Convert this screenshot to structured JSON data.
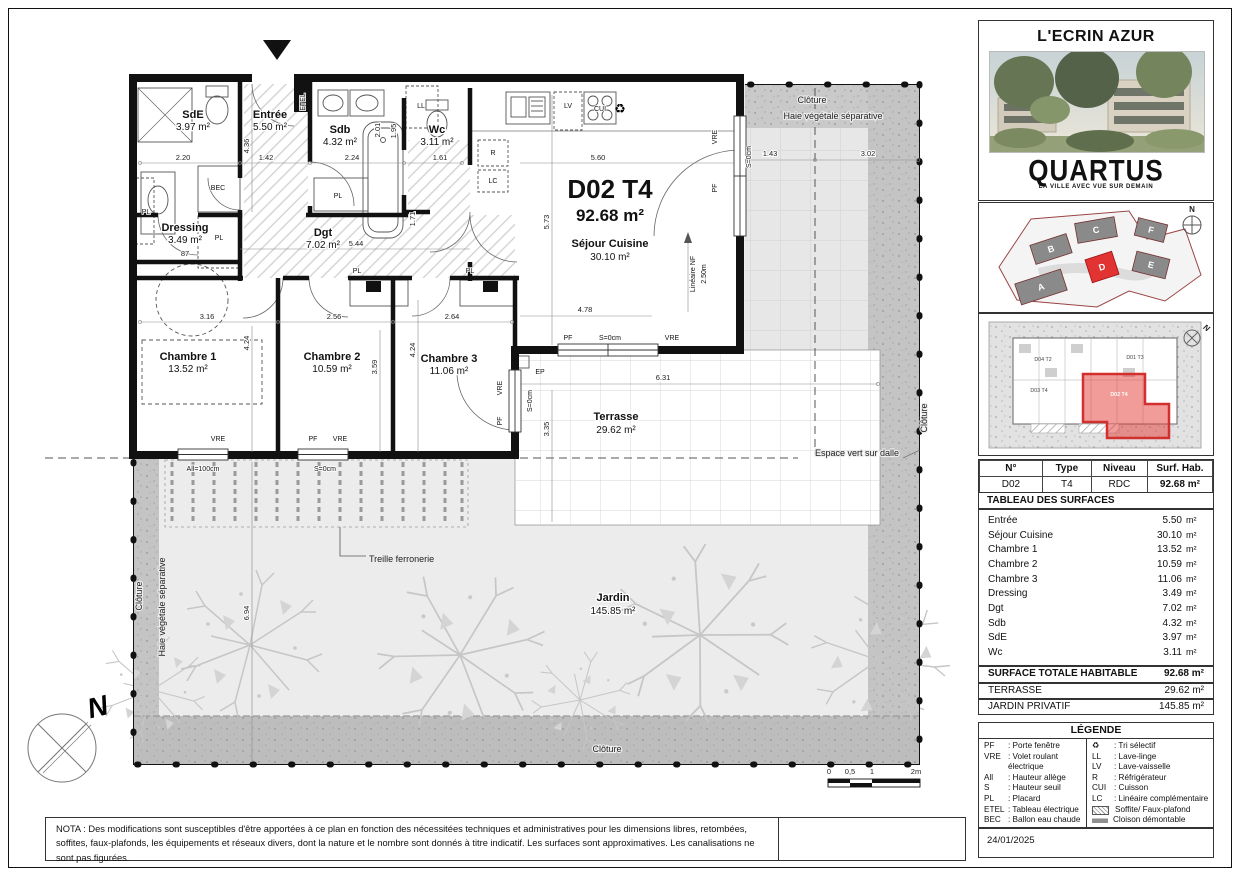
{
  "project": {
    "title": "L'ECRIN AZUR",
    "brand": "QUARTUS",
    "brand_tagline": "LA VILLE AVEC VUE SUR DEMAIN",
    "date": "24/01/2025",
    "north_letter": "N"
  },
  "info_table": {
    "headers": [
      "N°",
      "Type",
      "Niveau",
      "Surf. Hab."
    ],
    "row": [
      "D02",
      "T4",
      "RDC",
      "92.68 m²"
    ]
  },
  "surfaces": {
    "title": "TABLEAU DES SURFACES",
    "rows": [
      {
        "label": "Entrée",
        "value": "5.50",
        "unit": "m²"
      },
      {
        "label": "Séjour Cuisine",
        "value": "30.10",
        "unit": "m²"
      },
      {
        "label": "Chambre 1",
        "value": "13.52",
        "unit": "m²"
      },
      {
        "label": "Chambre 2",
        "value": "10.59",
        "unit": "m²"
      },
      {
        "label": "Chambre 3",
        "value": "11.06",
        "unit": "m²"
      },
      {
        "label": "Dressing",
        "value": "3.49",
        "unit": "m²"
      },
      {
        "label": "Dgt",
        "value": "7.02",
        "unit": "m²"
      },
      {
        "label": "Sdb",
        "value": "4.32",
        "unit": "m²"
      },
      {
        "label": "SdE",
        "value": "3.97",
        "unit": "m²"
      },
      {
        "label": "Wc",
        "value": "3.11",
        "unit": "m²"
      }
    ],
    "total": {
      "label": "SURFACE TOTALE HABITABLE",
      "value": "92.68 m²"
    },
    "terrasse": {
      "label": "TERRASSE",
      "value": "29.62 m²"
    },
    "jardin": {
      "label": "JARDIN PRIVATIF",
      "value": "145.85 m²"
    }
  },
  "legend": {
    "title": "LÉGENDE",
    "left": [
      {
        "abbr": "PF",
        "desc": ": Porte fenêtre"
      },
      {
        "abbr": "VRE",
        "desc": ": Volet roulant électrique"
      },
      {
        "abbr": "All",
        "desc": ": Hauteur allège"
      },
      {
        "abbr": "S",
        "desc": ": Hauteur seuil"
      },
      {
        "abbr": "PL",
        "desc": ": Placard"
      },
      {
        "abbr": "ETEL",
        "desc": ": Tableau électrique"
      },
      {
        "abbr": "BEC",
        "desc": ": Ballon eau chaude"
      }
    ],
    "right": [
      {
        "glyph": "♻",
        "desc": ": Tri sélectif"
      },
      {
        "glyph": "LL",
        "desc": ": Lave-linge"
      },
      {
        "glyph": "LV",
        "desc": ": Lave-vaisselle"
      },
      {
        "glyph": "R",
        "desc": ": Réfrigérateur"
      },
      {
        "glyph": "CUI",
        "desc": ": Cuisson"
      },
      {
        "glyph": "LC",
        "desc": ": Linéaire complémentaire"
      },
      {
        "glyph": "",
        "desc": "Soffite/ Faux-plafond"
      },
      {
        "glyph": "",
        "desc": "Cloison démontable"
      }
    ]
  },
  "site_plan": {
    "buildings": [
      "A",
      "B",
      "C",
      "D",
      "E",
      "F"
    ],
    "highlight": "D"
  },
  "unit_locator": {
    "labels": [
      "D04 T2",
      "D01 T3",
      "D03 T4"
    ],
    "highlight": "D02 T4"
  },
  "plan": {
    "unit_title": "D02 T4",
    "unit_area": "92.68 m²",
    "rooms": {
      "sde": {
        "name": "SdE",
        "area": "3.97 m²"
      },
      "entree": {
        "name": "Entrée",
        "area": "5.50 m²"
      },
      "sdb": {
        "name": "Sdb",
        "area": "4.32 m²"
      },
      "wc": {
        "name": "Wc",
        "area": "3.11 m²"
      },
      "dressing": {
        "name": "Dressing",
        "area": "3.49 m²"
      },
      "dgt": {
        "name": "Dgt",
        "area": "7.02 m²"
      },
      "ch1": {
        "name": "Chambre 1",
        "area": "13.52 m²"
      },
      "ch2": {
        "name": "Chambre 2",
        "area": "10.59 m²"
      },
      "ch3": {
        "name": "Chambre 3",
        "area": "11.06 m²"
      },
      "sejour": {
        "name": "Séjour Cuisine",
        "area": "30.10 m²"
      },
      "terrasse": {
        "name": "Terrasse",
        "area": "29.62 m²"
      },
      "jardin": {
        "name": "Jardin",
        "area": "145.85 m²"
      }
    },
    "labels": {
      "pf": "PF",
      "vre": "VRE",
      "pl": "PL",
      "ep": "EP",
      "bec": "BEC",
      "etel": "ETEL",
      "ll": "LL",
      "lv": "LV",
      "r": "R",
      "lc": "LC",
      "cui": "CUI",
      "tri": "♻",
      "s0": "S=0cm",
      "all100": "All=100cm",
      "lineaire_nf": "Linéaire NF",
      "lineaire_val": "2.50m"
    },
    "annotations": {
      "cloture": "Clôture",
      "haie": "Haie végétale séparative",
      "espace_vert": "Espace vert sur dalle",
      "treille": "Treille ferronerie"
    },
    "dims": {
      "d220": "2.20",
      "d436": "4.36",
      "d142": "1.42",
      "d224": "2.24",
      "d201": "2.01",
      "d195": "1.95",
      "d161": "1.61",
      "d560": "5.60",
      "d573": "5.73",
      "d544": "5.44",
      "d87": "87",
      "d316": "3.16",
      "d256": "2.56",
      "d264": "2.64",
      "d424": "4.24",
      "d359": "3.59",
      "d171": "1.71",
      "d478": "4.78",
      "d631": "6.31",
      "d335": "3.35",
      "d143": "1.43",
      "d302": "3.02",
      "d694": "6.94"
    }
  },
  "scale_bar": {
    "t0": "0",
    "t05": "0,5",
    "t1": "1",
    "t2": "2m"
  },
  "nota": "NOTA : Des modifications sont susceptibles d'être apportées à ce plan en fonction des nécessitées techniques et administratives pour les dimensions libres, retombées, soffites, faux-plafonds, les équipements et réseaux divers, dont la nature et le nombre sont donnés à titre indicatif. Les surfaces sont approximatives. Les canalisations ne sont pas figurées."
}
